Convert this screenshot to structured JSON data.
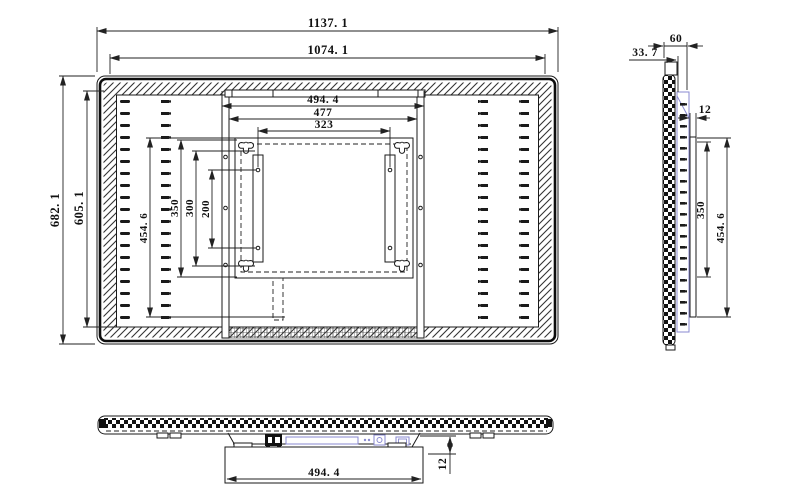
{
  "drawing": {
    "type": "technical-drawing",
    "subject": "flat panel display with wall-mount bracket, three orthographic views",
    "colors": {
      "line": "#1a1a1a",
      "accent_blue": "#8a8ad0",
      "background": "#ffffff"
    },
    "views": {
      "rear": {
        "dims": {
          "overall_width": "1137. 1",
          "inner_width": "1074. 1",
          "overall_height": "682. 1",
          "inner_height": "605. 1",
          "bracket_width": "494. 4",
          "rail_span": "477",
          "vesa_span_x": "323",
          "bracket_height": "454. 6",
          "rail_height": "350",
          "vesa_frame_height": "300",
          "vesa_span_y": "200"
        }
      },
      "side": {
        "dims": {
          "total_depth": "60",
          "panel_depth": "33. 7",
          "plate_thickness": "12",
          "rail_height": "350",
          "bracket_height": "454. 6"
        }
      },
      "bottom": {
        "dims": {
          "plate_width": "494. 4",
          "plate_depth": "12"
        }
      }
    }
  }
}
